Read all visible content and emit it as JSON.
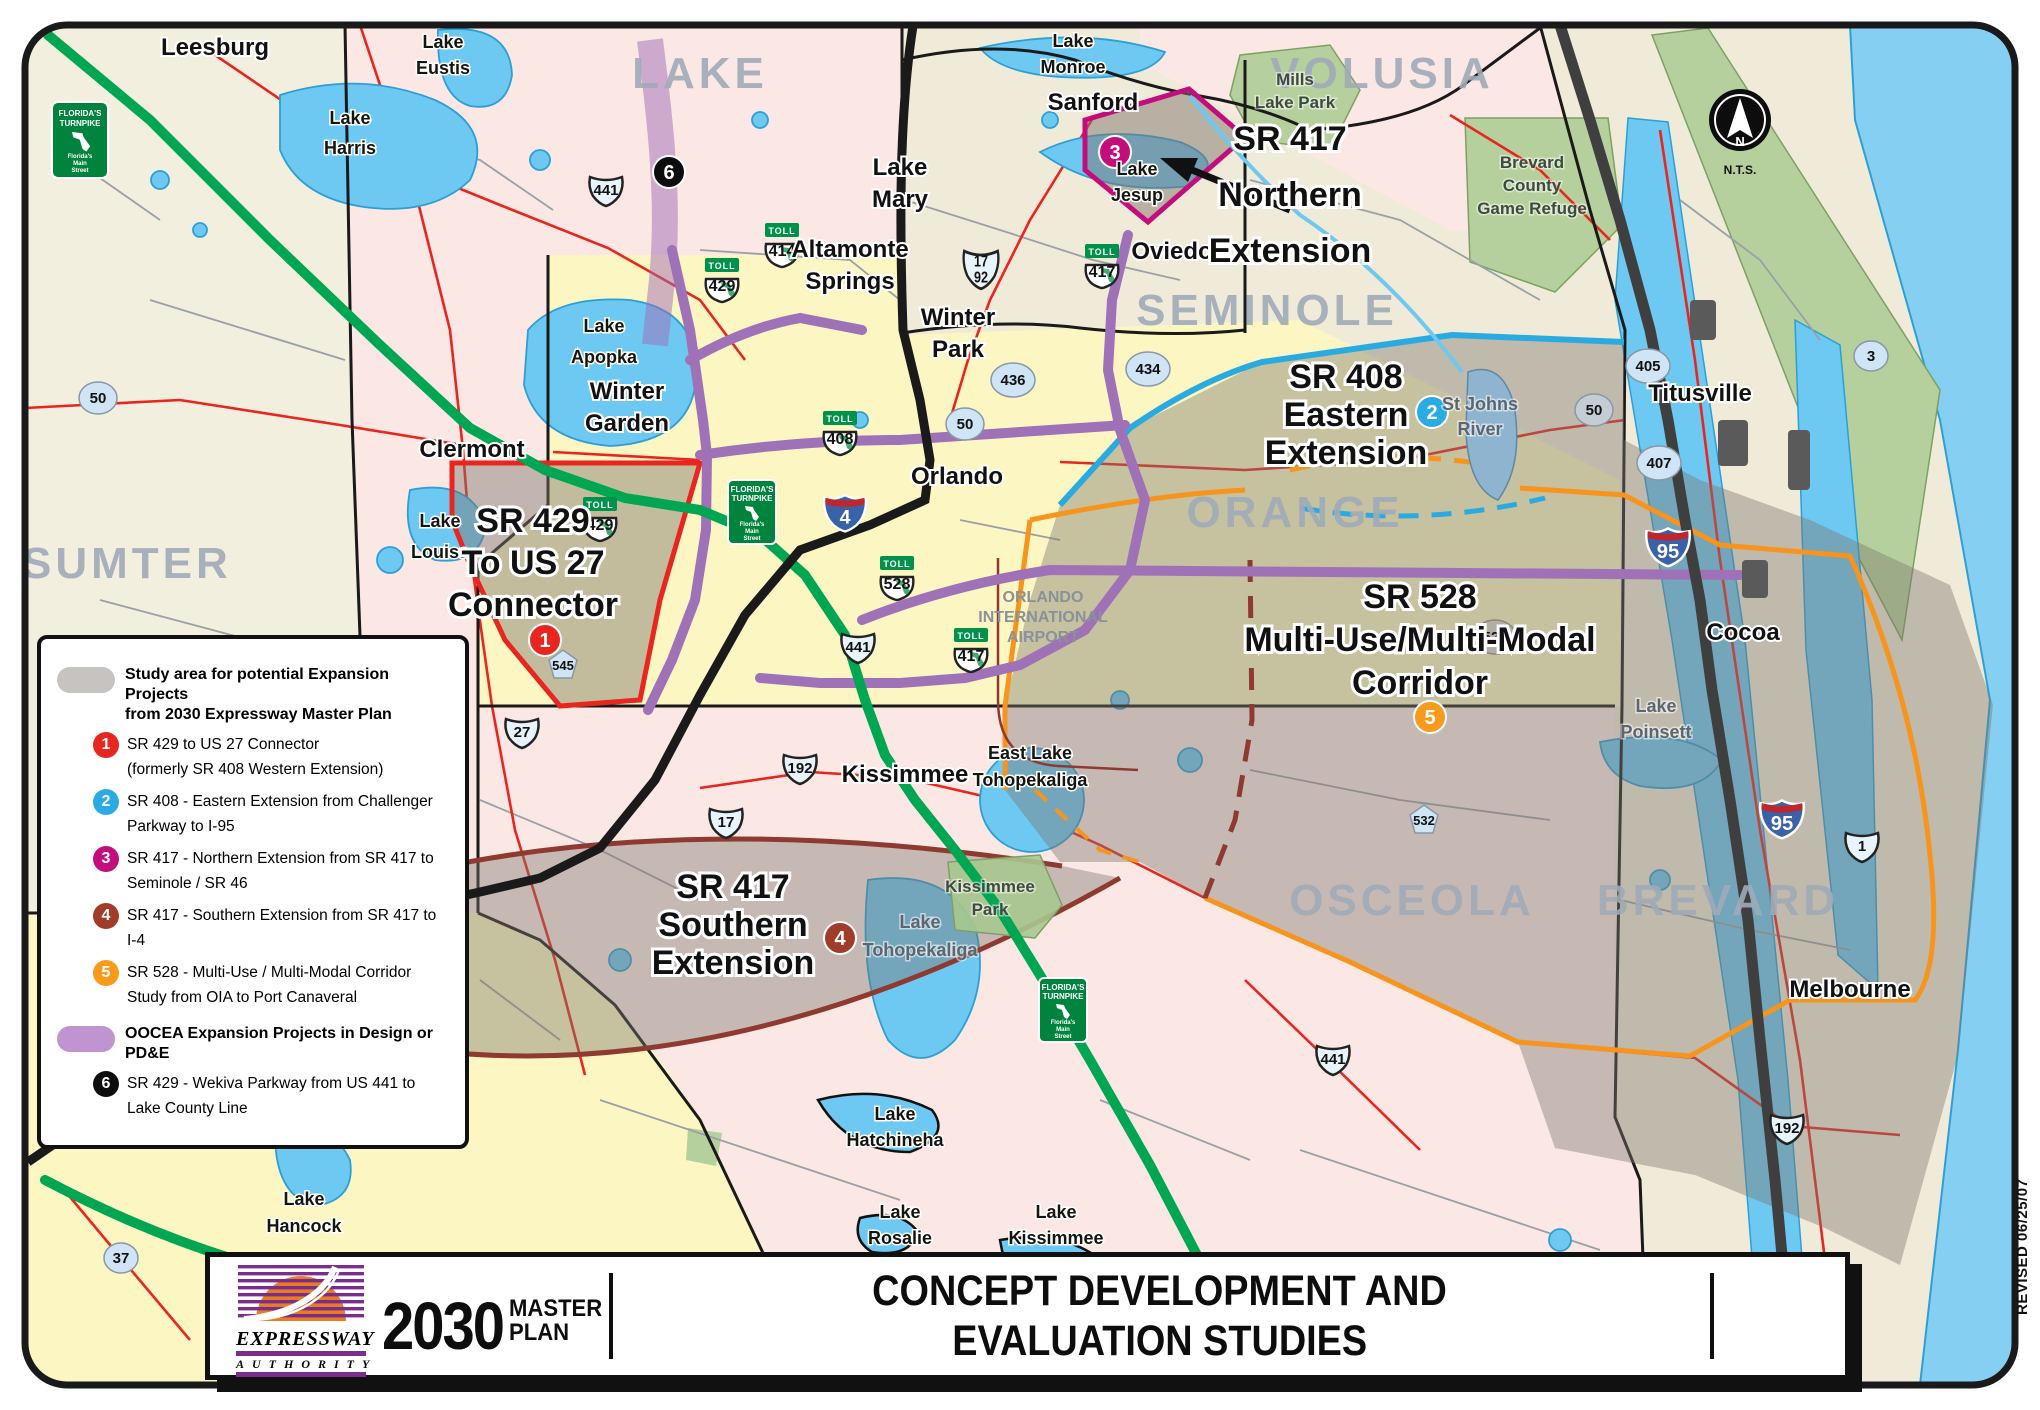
{
  "map": {
    "counties": {
      "sumter": "SUMTER",
      "lake": "LAKE",
      "volusia": "VOLUSIA",
      "seminole": "SEMINOLE",
      "orange": "ORANGE",
      "osceola": "OSCEOLA",
      "brevard": "BREVARD"
    },
    "cities": {
      "leesburg": "Leesburg",
      "sanford": "Sanford",
      "oviedo": "Oviedo",
      "orlando": "Orlando",
      "clermont": "Clermont",
      "kissimmee": "Kissimmee",
      "titusville": "Titusville",
      "cocoa": "Cocoa",
      "melbourne": "Melbourne",
      "lake_mary": [
        "Lake",
        "Mary"
      ],
      "altamonte": [
        "Altamonte",
        "Springs"
      ],
      "winter_park": [
        "Winter",
        "Park"
      ],
      "winter_garden": [
        "Winter",
        "Garden"
      ]
    },
    "lakes": {
      "eustis": [
        "Lake",
        "Eustis"
      ],
      "harris": [
        "Lake",
        "Harris"
      ],
      "monroe": [
        "Lake",
        "Monroe"
      ],
      "jesup": [
        "Lake",
        "Jesup"
      ],
      "apopka": [
        "Lake",
        "Apopka"
      ],
      "louisa": [
        "Lake",
        "Louisa"
      ],
      "east_toho": [
        "East Lake",
        "Tohopekaliga"
      ],
      "toho": [
        "Lake",
        "Tohopekaliga"
      ],
      "hatchineha": [
        "Lake",
        "Hatchineha"
      ],
      "hancock": [
        "Lake",
        "Hancock"
      ],
      "rosalie": [
        "Lake",
        "Rosalie"
      ],
      "kissimmee_lake": [
        "Lake",
        "Kissimmee"
      ],
      "poinsett": [
        "Lake",
        "Poinsett"
      ],
      "st_johns": [
        "St Johns",
        "River"
      ]
    },
    "parks": {
      "mills": [
        "Mills",
        "Lake Park"
      ],
      "game_refuge": [
        "Brevard",
        "County",
        "Game Refuge"
      ],
      "kissimmee_park": [
        "Kissimmee",
        "Park"
      ]
    },
    "airport": [
      "ORLANDO",
      "INTERNATIONAL",
      "AIRPORT"
    ],
    "studies": {
      "sr429": [
        "SR 429",
        "To US 27",
        "Connector"
      ],
      "sr408": [
        "SR 408",
        "Eastern",
        "Extension"
      ],
      "sr417n": [
        "SR 417",
        "Northern",
        "Extension"
      ],
      "sr417s": [
        "SR 417",
        "Southern",
        "Extension"
      ],
      "sr528": [
        "SR 528",
        "Multi-Use/Multi-Modal",
        "Corridor"
      ]
    },
    "badges": [
      "1",
      "2",
      "3",
      "4",
      "5",
      "6"
    ],
    "shields": {
      "toll": "TOLL",
      "i4": "4",
      "i95": "95",
      "t408": "408",
      "t414": "414",
      "t417": "417",
      "t429": "429",
      "t528": "528",
      "us441": "441",
      "us27": "27",
      "us192": "192",
      "us17": "17",
      "us17_92": [
        "17",
        "92"
      ],
      "us1": "1",
      "sr50": "50",
      "sr436": "436",
      "sr434": "434",
      "sr405": "405",
      "sr407": "407",
      "sr3": "3",
      "sr37": "37",
      "sr528": "528",
      "cr545": "545",
      "cr532": "532"
    },
    "turnpike_sign": [
      "FLORIDA'S",
      "TURNPIKE",
      "Florida's",
      "Main",
      "Street"
    ],
    "compass": {
      "n": "N",
      "nts": "N.T.S."
    }
  },
  "legend": {
    "study_title_1": "Study area for potential Expansion Projects",
    "study_title_2": "from 2030 Expressway Master Plan",
    "items": [
      {
        "num": "1",
        "color": "#e8251f",
        "line1": "SR 429 to US 27 Connector",
        "line2": "(formerly SR 408 Western Extension)"
      },
      {
        "num": "2",
        "color": "#2aabe4",
        "line1": "SR 408 - Eastern Extension from Challenger",
        "line2": "Parkway to I-95"
      },
      {
        "num": "3",
        "color": "#c40d7d",
        "line1": "SR 417 - Northern Extension from SR 417 to",
        "line2": "Seminole / SR 46"
      },
      {
        "num": "4",
        "color": "#a13c2a",
        "line1": "SR 417 - Southern Extension from SR 417 to",
        "line2": "I-4"
      },
      {
        "num": "5",
        "color": "#f89a1c",
        "line1": "SR 528 - Multi-Use / Multi-Modal Corridor",
        "line2": "Study from OIA to Port Canaveral"
      }
    ],
    "oocea_title": "OOCEA Expansion Projects in Design or PD&E",
    "item6": {
      "num": "6",
      "color": "#0d0d0d",
      "line1": "SR 429 - Wekiva Parkway from US 441 to",
      "line2": "Lake County Line"
    }
  },
  "banner": {
    "logo_line1": "EXPRESSWAY",
    "logo_line2": "AUTHORITY",
    "brand_year": "2030",
    "brand_master": "MASTER",
    "brand_plan": "PLAN",
    "title_line1": "CONCEPT DEVELOPMENT AND",
    "title_line2": "EVALUATION STUDIES"
  },
  "revised": "REVISED 06/25/07",
  "colors": {
    "turnpike_green": "#00a651",
    "toll_purple": "#9f72b8",
    "interstate_black": "#1a1a1a",
    "study_gray": "#7d766e",
    "water": "#6dc8f2",
    "ocean": "#85d0f2",
    "badge1": "#e8251f",
    "badge2": "#2aabe4",
    "badge3": "#c40d7d",
    "badge4": "#a13c2a",
    "badge5": "#f89a1c",
    "badge6": "#0d0d0d",
    "boundary_orange": "#f7941d",
    "boundary_blue": "#29abe2",
    "boundary_red": "#e8251f",
    "boundary_maroon": "#8f3a30",
    "county_pink": "#fbe7e4",
    "county_yellow": "#fcf6c2",
    "county_beige": "#f0ebd8"
  }
}
